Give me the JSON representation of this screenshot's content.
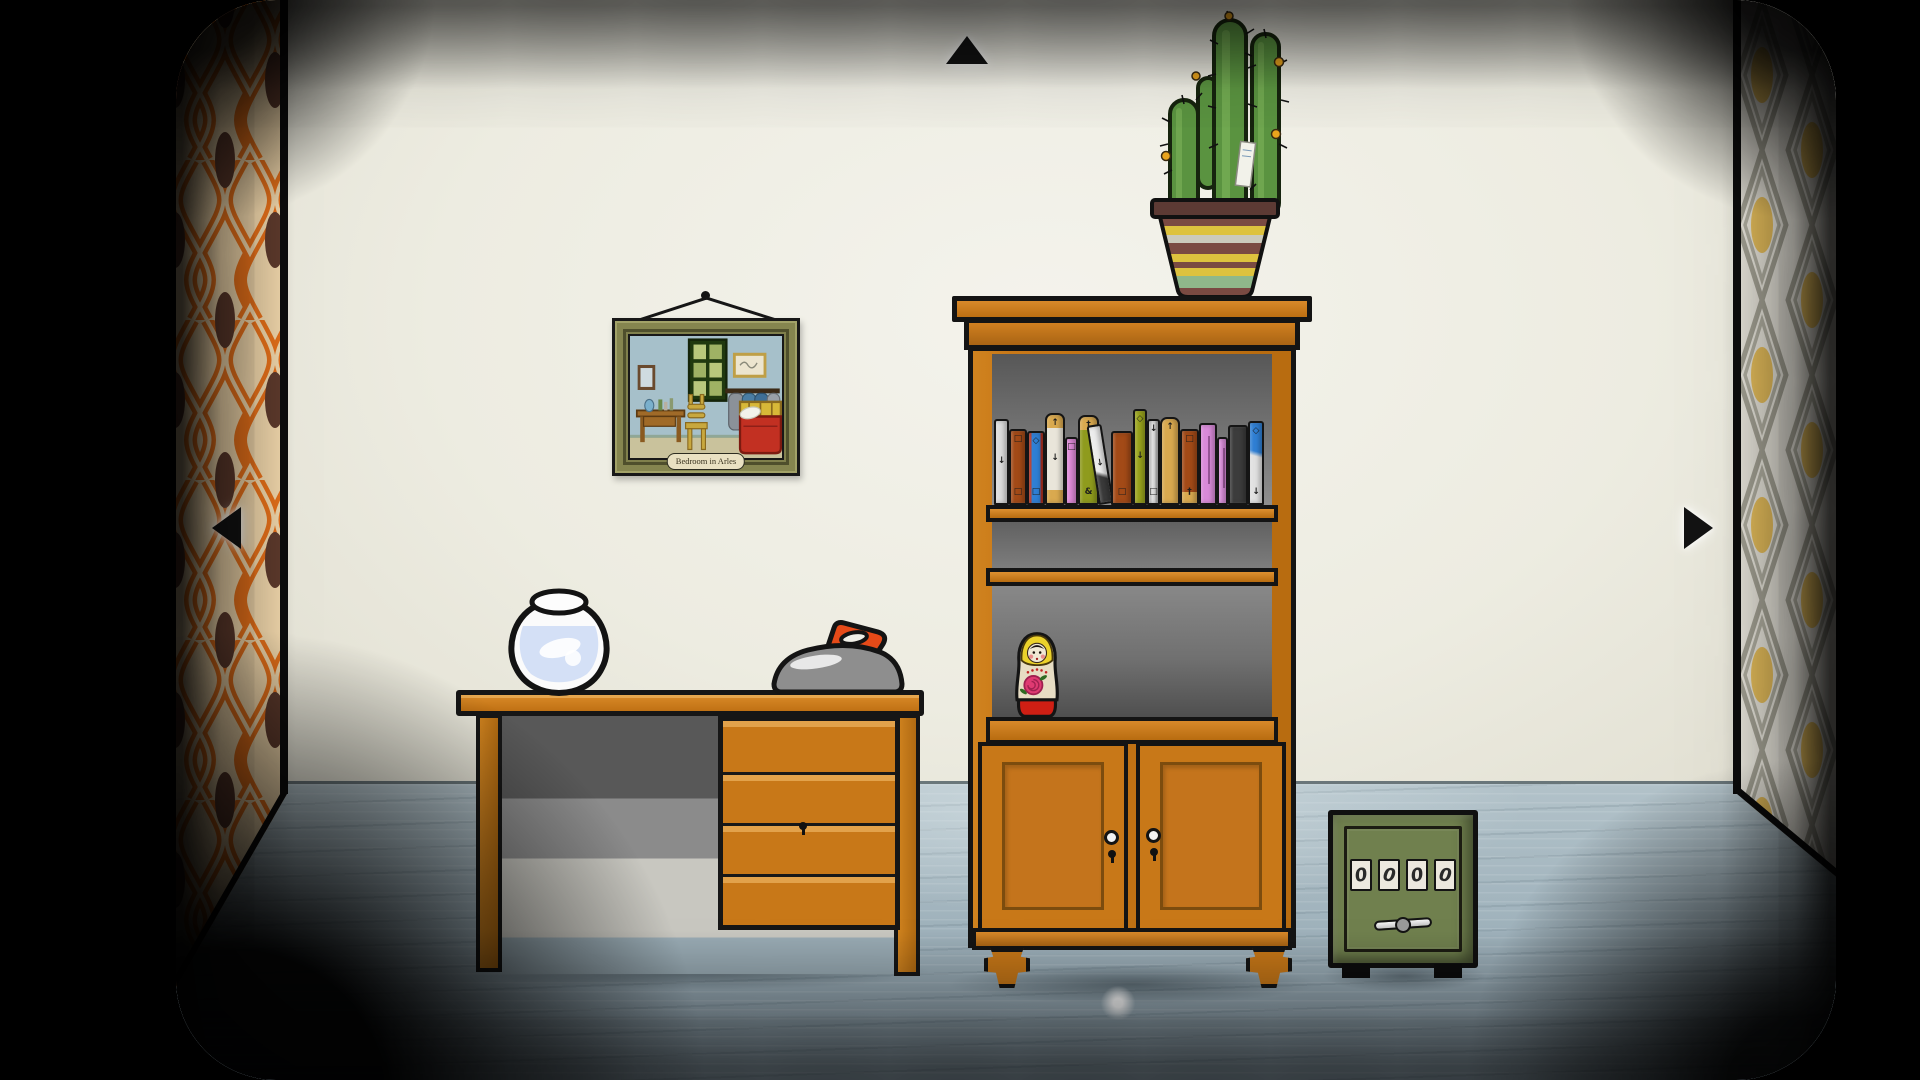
{
  "painting": {
    "label": "Bedroom in Arles"
  },
  "safe": {
    "dials": [
      "0",
      "0",
      "0",
      "0"
    ]
  },
  "navigation": {
    "up_icon": "▲",
    "left_icon": "◀",
    "right_icon": "▶"
  },
  "books": [
    {
      "w": 15,
      "h": 86,
      "color": "#dcdcdc",
      "syms": [
        "",
        "↓",
        ""
      ]
    },
    {
      "w": 18,
      "h": 76,
      "color": "#a34a17",
      "syms": [
        "□",
        "",
        "□"
      ]
    },
    {
      "w": 18,
      "h": 74,
      "color": "#2f7fd4",
      "stripe": "#b03020",
      "syms": [
        "◇",
        "",
        "□"
      ]
    },
    {
      "w": 20,
      "h": 92,
      "color": "#e9e5da",
      "capTop": "#d9a94f",
      "capBot": "#d9a94f",
      "round": true,
      "syms": [
        "↑",
        "↓",
        ""
      ]
    },
    {
      "w": 13,
      "h": 68,
      "color": "#e08ad8",
      "syms": [
        "□",
        "",
        ""
      ]
    },
    {
      "w": 21,
      "h": 90,
      "color": "#8f9b1d",
      "capTop": "#d9a94f",
      "round": true,
      "syms": [
        "†",
        "",
        "&"
      ]
    },
    {
      "w": 15,
      "h": 80,
      "color": "#ececec",
      "lean": true,
      "darkBot": true,
      "syms": [
        "",
        "↓",
        ""
      ]
    },
    {
      "w": 22,
      "h": 74,
      "color": "#a34a17",
      "syms": [
        "",
        "",
        "□"
      ]
    },
    {
      "w": 14,
      "h": 96,
      "color": "#9aa41c",
      "syms": [
        "◇",
        "↓",
        ""
      ]
    },
    {
      "w": 13,
      "h": 86,
      "color": "#e6e6e6",
      "stripe": "#bdbdbd",
      "syms": [
        "↓",
        "",
        "□"
      ]
    },
    {
      "w": 20,
      "h": 88,
      "color": "#d9a94f",
      "round": true,
      "syms": [
        "↑",
        "",
        ""
      ]
    },
    {
      "w": 19,
      "h": 76,
      "color": "#a34a17",
      "capBot": "#d9a94f",
      "syms": [
        "□",
        "",
        "†"
      ]
    },
    {
      "w": 18,
      "h": 82,
      "color": "#d98ad9",
      "line": true,
      "syms": [
        "",
        "",
        ""
      ]
    },
    {
      "w": 11,
      "h": 68,
      "color": "#dd90dd",
      "line": true,
      "syms": [
        "",
        "",
        ""
      ]
    },
    {
      "w": 20,
      "h": 80,
      "color": "#3c3c3c",
      "syms": [
        "",
        "",
        ""
      ]
    },
    {
      "w": 16,
      "h": 84,
      "color": "#2f7fd4",
      "twoTone": "#e0e0e0",
      "syms": [
        "◇",
        "",
        "↓"
      ]
    }
  ],
  "colors": {
    "wall": "#f0efe7",
    "floor": "#a9bbc3",
    "wood": "#c87818",
    "outline": "#141414",
    "safe_green": "#70804e",
    "dial_face": "#ece8de",
    "wallpaper_left_cream": "#f3d9ad",
    "wallpaper_left_orange": "#e8711a",
    "wallpaper_left_brown": "#5f3b2d",
    "wallpaper_right_ground": "#efece2",
    "wallpaper_right_gray": "#a8a698",
    "wallpaper_right_yellow": "#ecc35e",
    "iron_red": "#e64a18",
    "matryoshka_hood": "#ecd22b",
    "matryoshka_base": "#cf1f14",
    "rose_pink": "#df3a72",
    "cactus_green": "#5a9340",
    "shelf_interior": "#6e6e6e"
  }
}
